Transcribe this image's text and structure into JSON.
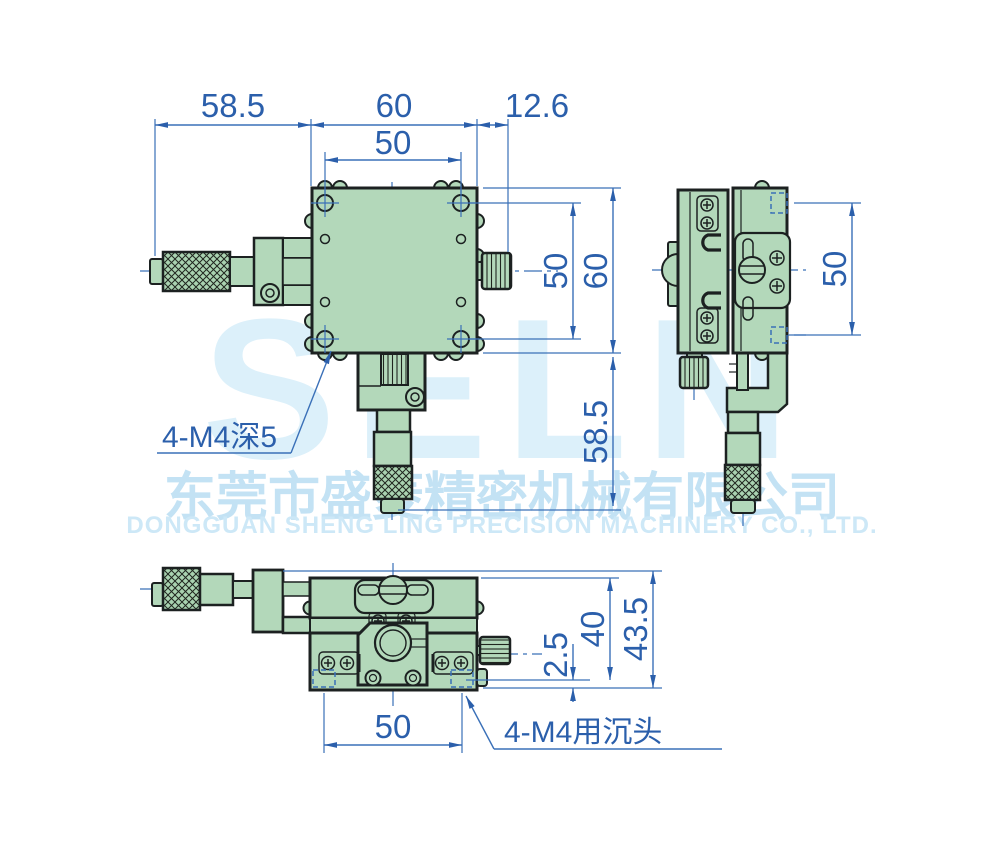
{
  "watermark": {
    "logo": "SELN",
    "company_cn": "东莞市盛菱精密机械有限公司",
    "company_en": "DONGGUAN SHENG LING PRECISION MACHINERY CO., LTD."
  },
  "colors": {
    "part_fill": "#b3d8ba",
    "outline": "#1c2121",
    "dimension_blue": "#2b5fab",
    "watermark_blue": "#cde8f7"
  },
  "views": {
    "front": {
      "dims": {
        "width_left": "58.5",
        "width_body": "60",
        "width_right": "12.6",
        "hole_pitch_top": "50",
        "hole_pitch_right": "50",
        "height_body": "60",
        "height_lower": "58.5"
      },
      "note": "4-M4深5"
    },
    "side": {
      "dims": {
        "hole_pitch": "50"
      }
    },
    "bottom": {
      "dims": {
        "hole_pitch": "50",
        "base_thickness": "2.5",
        "height_inner": "40",
        "height_total": "43.5"
      },
      "note": "4-M4用沉头"
    }
  }
}
